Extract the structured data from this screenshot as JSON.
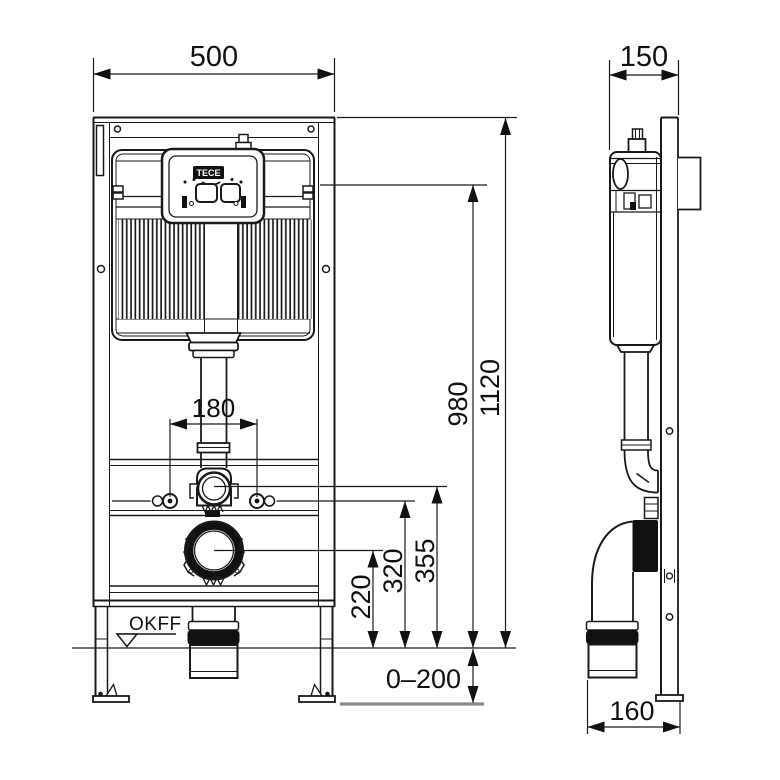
{
  "drawing": {
    "brand": "TECE",
    "floor_level_label": "OKFF",
    "dimensions": {
      "front_width": "500",
      "side_depth": "150",
      "frame_height": "1120",
      "actuator_height": "980",
      "bend_height": "355",
      "bolt_height": "320",
      "drain_height": "220",
      "bolt_spacing": "180",
      "foot_adjustment": "0–200",
      "outlet_offset": "160"
    }
  }
}
